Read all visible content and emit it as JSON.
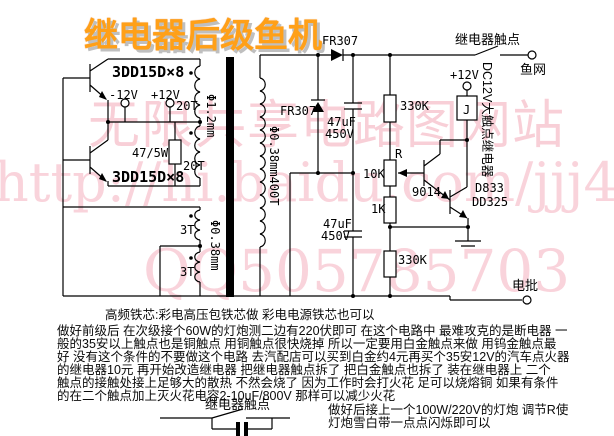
{
  "title": "继电器后级鱼机",
  "watermark": {
    "site": "无限共享电路图网站",
    "url": "http://hi.baidu.com/jjj4",
    "qq": "QQ505785703"
  },
  "labels": {
    "q1": "3DD15D×8",
    "q2": "3DD15D×8",
    "v_neg": "-12V",
    "v_pos": "+12V",
    "t20a": "20T",
    "t20b": "20T",
    "r_base": "47/5W",
    "wire_primary": "Φ1.2mm",
    "t3a": "3T",
    "t3b": "3T",
    "wire_feedback": "Φ0.38mm",
    "secondary": "Φ0.38mm400T",
    "d1": "FR307",
    "d2": "FR307",
    "c1_value": "47uF",
    "c1_volt": "450V",
    "c2_value": "47uF",
    "c2_volt": "450V",
    "r1": "330K",
    "r_adj": "R",
    "pot": "10K",
    "r2": "1K",
    "r3": "330K",
    "q3": "9014",
    "q4a": "D833",
    "q4b": "DD325",
    "relay_contact": "继电器触点",
    "fishnet": "鱼网",
    "v_pos_relay": "+12V",
    "relay_coil": "J",
    "relay_type": "DC12V大触点继电器",
    "dianpi": "电批"
  },
  "notes": {
    "l1": "高频铁芯:彩电高压包铁芯做 彩电电源铁芯也可以",
    "l2": "做好前级后 在次级接个60W的灯炮测二边有220伏即可 在这个电路中 最难攻克的是断电器 一",
    "l3": "般的35安以上触点也是铜触点 用铜触点很快烧掉 所以一定要用白金触点来做 用钨金触点最",
    "l4": "好 没有这个条件的不要做这个电路 去汽配店可以买到白金约4元再买个35安12V的汽车点火器",
    "l5": "的继电器10元 再开始改造继电器 把继电器触点拆了 把白金触点也拆了 装在继电器上 二个",
    "l6": "触点的接触处接上足够大的散热 不然会烧了 因为工作时会打火花 足可以烧熔铜 如果有条件",
    "l7": "的在二个触点加上灭火花电容2-10uF/800V 那样可以减少火花"
  },
  "footer": {
    "contact_label": "继电器触点",
    "tip1": "做好后接上一个100W/220V的灯炮 调节R使",
    "tip2": "灯炮雪白带一点点闪烁即可以"
  },
  "colors": {
    "background": "#ffffff",
    "line": "#000000",
    "title": "#ffa018",
    "watermark": "#f4a9b8"
  }
}
